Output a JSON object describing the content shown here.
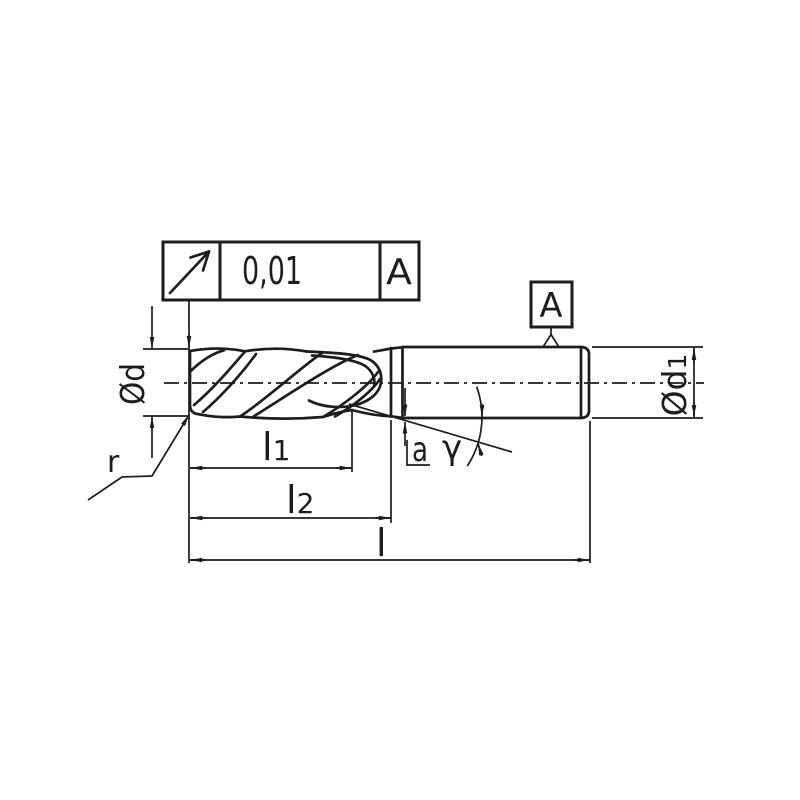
{
  "drawing": {
    "title": "end-mill-technical-drawing",
    "ink_color": "#1d1d1b",
    "background_color": "#ffffff",
    "tolerance_frame": {
      "symbol": "circular-runout",
      "value": "0,01",
      "datum_ref": "A"
    },
    "datum_flag": {
      "label": "A"
    },
    "dims": {
      "d": {
        "text": "Ød"
      },
      "d1": {
        "base": "Ød",
        "sub": "1"
      },
      "l1": {
        "base": "l",
        "sub": "1"
      },
      "l2": {
        "base": "l",
        "sub": "2"
      },
      "l": {
        "base": "l"
      },
      "a": {
        "base": "a"
      },
      "gamma": {
        "base": "γ"
      },
      "r": {
        "base": "r"
      }
    }
  }
}
